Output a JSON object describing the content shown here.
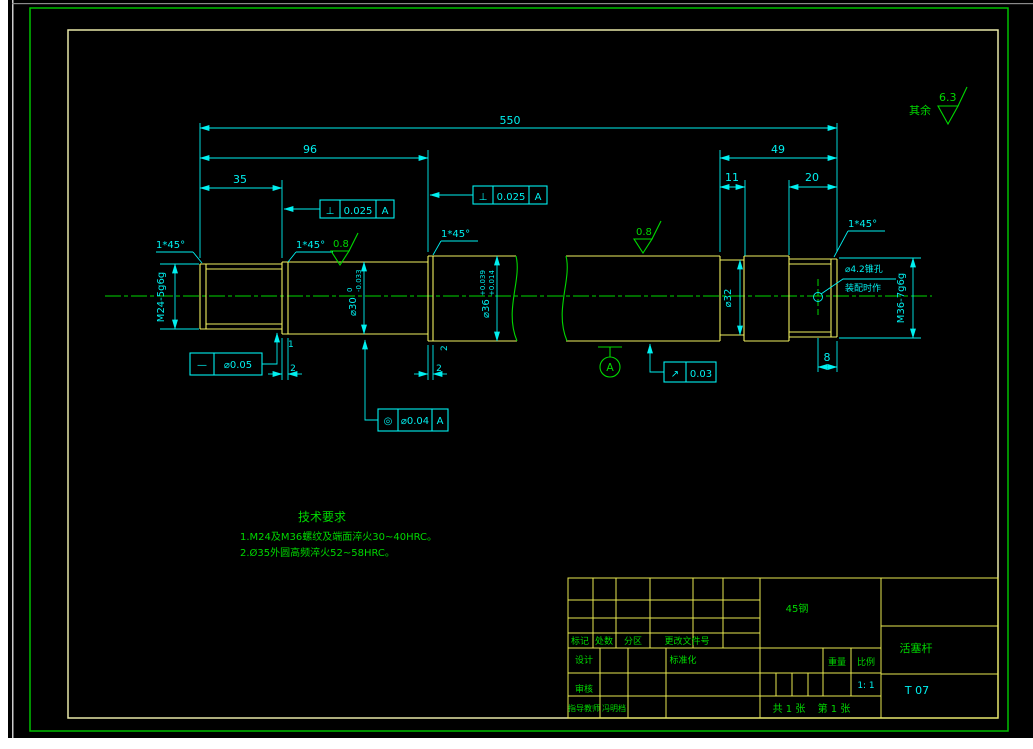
{
  "colors": {
    "background": "#000000",
    "dimension_cyan": "#00f0f0",
    "annotation_green": "#00d800",
    "outline_yellow": "#f0f060",
    "titleblock_grid": "#e8e850",
    "outer_frame_green": "#00c000",
    "inner_frame_pale": "#e8e8a8",
    "paper_edge_white": "#ffffff"
  },
  "annotations": {
    "general_roughness_label": "其余",
    "general_roughness_value": "6.3",
    "local_roughness": "0.8",
    "chamfer": "1*45°",
    "taper_hole_line1": "⌀4.2锥孔",
    "taper_hole_line2": "装配时作",
    "datum": "A"
  },
  "dimensions": {
    "overall": "550",
    "seg96": "96",
    "seg35": "35",
    "seg49": "49",
    "seg11": "11",
    "seg20": "20",
    "seg8": "8",
    "small1": "1",
    "small2": "2",
    "thread_left": "M24-5g6g",
    "thread_right": "M36-7g6g",
    "dia30": "⌀30",
    "dia30_upper": "0",
    "dia30_lower": "-0.033",
    "dia36": "⌀36",
    "dia36_upper": "+0.039",
    "dia36_lower": "+0.014",
    "dia32": "⌀32"
  },
  "gdt": {
    "perpendicularity_symbol": "⊥",
    "perpendicularity_value": "0.025",
    "straightness_symbol": "—",
    "straightness_value": "⌀0.05",
    "concentricity_symbol": "◎",
    "concentricity_value": "⌀0.04",
    "runout_symbol": "↗",
    "runout_value": "0.03",
    "datum_ref": "A"
  },
  "tech_requirements": {
    "title": "技术要求",
    "item1": "1.M24及M36螺纹及端面淬火30~40HRC。",
    "item2": "2.Ø35外圆高频淬火52~58HRC。"
  },
  "title_block": {
    "material": "45钢",
    "col_mark": "标记",
    "col_count": "处数",
    "col_zone": "分区",
    "col_change_doc": "更改文件号",
    "design": "设计",
    "standardization": "标准化",
    "review": "审核",
    "teacher_label": "指导教师",
    "teacher_name": "冯明档",
    "weight": "重量",
    "scale": "比例",
    "scale_value": "1: 1",
    "sheet_total": "共 1 张",
    "sheet_number": "第 1 张",
    "part_name": "活塞杆",
    "drawing_number": "T 07"
  }
}
